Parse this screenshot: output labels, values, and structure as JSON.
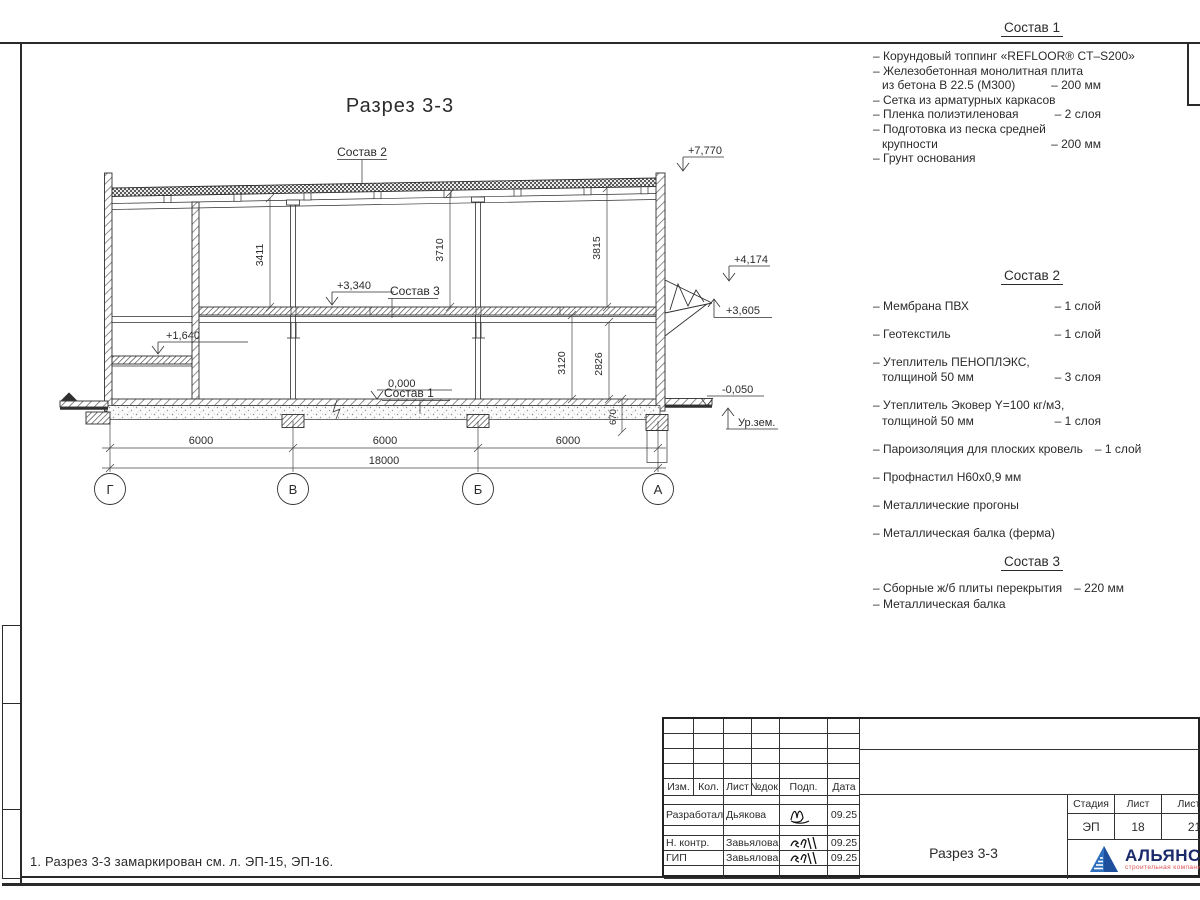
{
  "note": "1. Разрез 3-3 замаркирован см. л. ЭП-15, ЭП-16.",
  "drawing": {
    "title": "Разрез 3-3",
    "roof_label": "Состав 2",
    "slab_label": "Состав 3",
    "floor_label": "Состав 1",
    "elev_roof": "+7,770",
    "elev_canopy_top": "+4,174",
    "elev_canopy_bot": "+3,605",
    "elev_slab": "+3,340",
    "elev_mezz": "+1,640",
    "elev_zero": "0,000",
    "elev_apron": "-0,050",
    "ground_label": "Ур.зем.",
    "dim_3411": "3411",
    "dim_3710": "3710",
    "dim_3815": "3815",
    "dim_3120": "3120",
    "dim_2826": "2826",
    "dim_670": "670",
    "dim_span_1": "6000",
    "dim_span_2": "6000",
    "dim_span_3": "6000",
    "dim_total": "18000",
    "axis_1": "Г",
    "axis_2": "В",
    "axis_3": "Б",
    "axis_4": "А"
  },
  "specs": {
    "s1": {
      "title": "Состав 1",
      "items": [
        {
          "text": "– Корундовый топпинг «REFLOOR® CT–S200»",
          "qty": ""
        },
        {
          "text": "– Железобетонная  монолитная плита",
          "qty": ""
        },
        {
          "text": "из бетона В 22.5 (М300)",
          "qty": "– 200 мм",
          "indent": true
        },
        {
          "text": "– Сетка из арматурных каркасов",
          "qty": ""
        },
        {
          "text": "– Пленка полиэтиленовая",
          "qty": "– 2 слоя"
        },
        {
          "text": "– Подготовка из песка средней",
          "qty": ""
        },
        {
          "text": "крупности",
          "qty": "– 200 мм",
          "indent": true
        },
        {
          "text": "– Грунт основания",
          "qty": ""
        }
      ]
    },
    "s2": {
      "title": "Состав 2",
      "items": [
        {
          "text": "– Мембрана ПВХ",
          "qty": "– 1 слой"
        },
        {
          "text": "– Геотекстиль",
          "qty": "– 1 слой",
          "gap": true
        },
        {
          "text": "– Утеплитель ПЕНОПЛЭКС,",
          "qty": "",
          "gap": true
        },
        {
          "text": "толщиной 50 мм",
          "qty": "– 3 слоя",
          "indent": true
        },
        {
          "text": "– Утеплитель Эковер Y=100 кг/м3,",
          "qty": "",
          "gap": true
        },
        {
          "text": "толщиной 50 мм",
          "qty": "– 1 слоя",
          "indent": true
        },
        {
          "text": "– Пароизоляция для плоских кровель",
          "qty": "– 1 слой",
          "gap": true
        },
        {
          "text": "– Профнастил Н60х0,9 мм",
          "qty": "",
          "gap": true
        },
        {
          "text": "– Металлические прогоны",
          "qty": "",
          "gap": true
        },
        {
          "text": "– Металлическая балка (ферма)",
          "qty": "",
          "gap": true
        }
      ]
    },
    "s3": {
      "title": "Состав 3",
      "items": [
        {
          "text": "– Сборные ж/б плиты перекрытия",
          "qty": "– 220 мм"
        },
        {
          "text": "– Металлическая балка",
          "qty": ""
        }
      ]
    }
  },
  "titleblock": {
    "rev_cols": [
      "Изм.",
      "Кол.",
      "Лист",
      "№док.",
      "Подп.",
      "Дата"
    ],
    "rows": [
      {
        "role": "Разработал",
        "name": "Дьякова",
        "date": "09.25"
      },
      {
        "role": "Н. контр.",
        "name": "Завьялова",
        "date": "09.25"
      },
      {
        "role": "ГИП",
        "name": "Завьялова",
        "date": "09.25"
      }
    ],
    "doc_name": "Разрез 3-3",
    "stage_label": "Стадия",
    "sheet_label": "Лист",
    "sheets_label": "Листов",
    "stage": "ЭП",
    "sheet": "18",
    "sheets": "21",
    "logo_name": "АЛЬЯНС",
    "logo_subtitle": "строительная компания"
  }
}
